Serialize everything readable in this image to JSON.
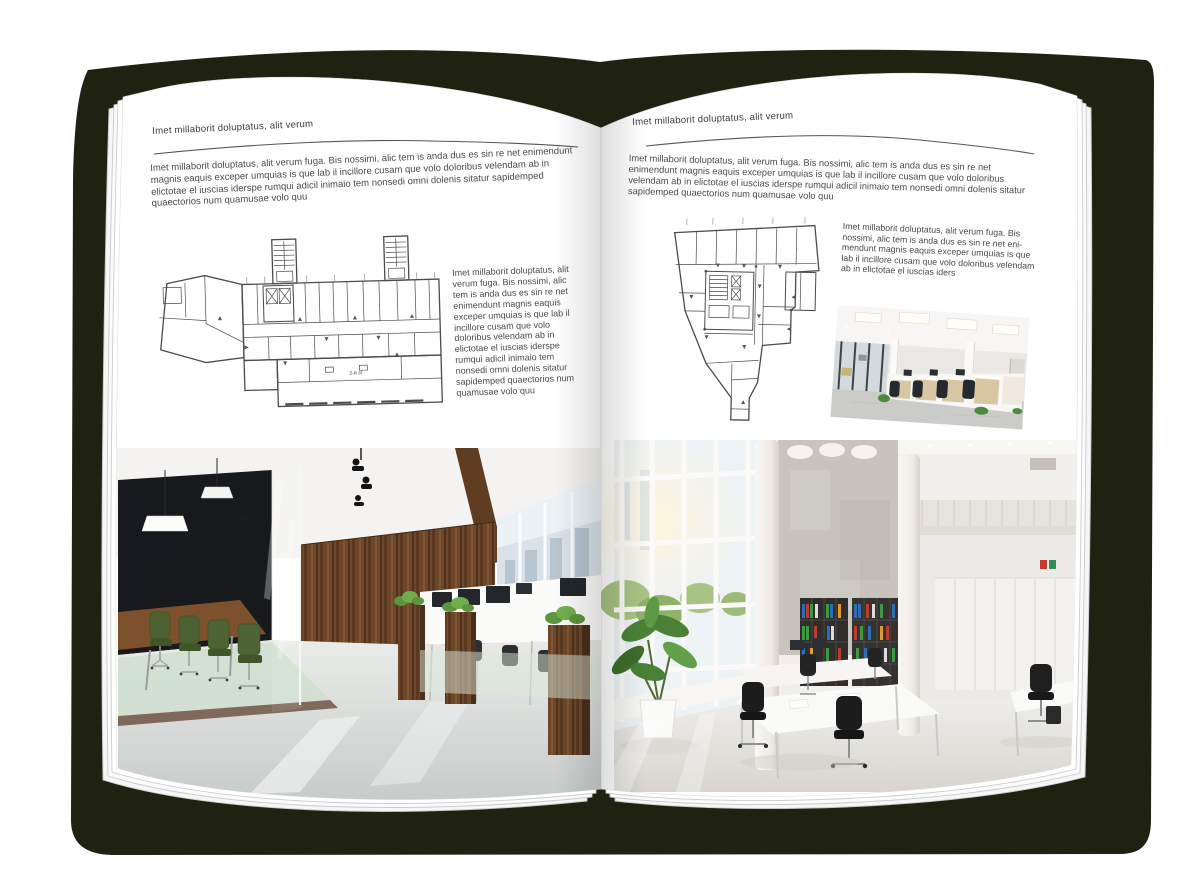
{
  "left_page": {
    "header": "Imet millaborit doluptatus, alit verum",
    "intro": "Imet millaborit doluptatus, alit verum fuga. Bis nossimi, alic tem is anda dus es sin re net enimendunt magnis eaquis exceper umquias is que lab il incillore cusam que volo doloribus velendam ab in elictotae el iuscias iderspe rumqui adicil inimaio tem nonsedi omni dolenis sitatur sapidemped quaectorios num quamusae volo quu",
    "side_text": "Imet millaborit doluptatus, alit verum fuga. Bis nossimi, alic tem is anda dus es sin re net enimendunt magnis eaquis exceper umquias is que lab il incillore cusam que volo doloribus velendam ab in elictotae el iuscias iderspe rumqui adicil inimaio tem nonsedi omni dolenis sitatur sapidemped quaectorios num quamusae volo quu",
    "floorplan_label": "2-й эт"
  },
  "right_page": {
    "header": "Imet millaborit doluptatus, alit verum",
    "intro": "Imet millaborit doluptatus, alit verum fuga. Bis nossimi, alic tem is anda dus es sin re net enimendunt magnis eaquis exceper umquias is que lab il incillore cusam que volo doloribus velendam ab in elictotae el iuscias iderspe rumqui adicil inimaio tem nonsedi omni dolenis sitatur sapidemped quaectorios num quamusae volo quu",
    "side_text": "Imet millaborit doluptatus, alit verum fuga. Bis nossimi, alic tem is anda dus es sin re net eni-mendunt magnis eaquis exceper umquias is que lab il incillore cusam que volo doloribus velendam ab in elictotae el iuscias iders"
  },
  "colors": {
    "cover": "#1f2210",
    "page": "#ffffff",
    "text": "#454545"
  }
}
